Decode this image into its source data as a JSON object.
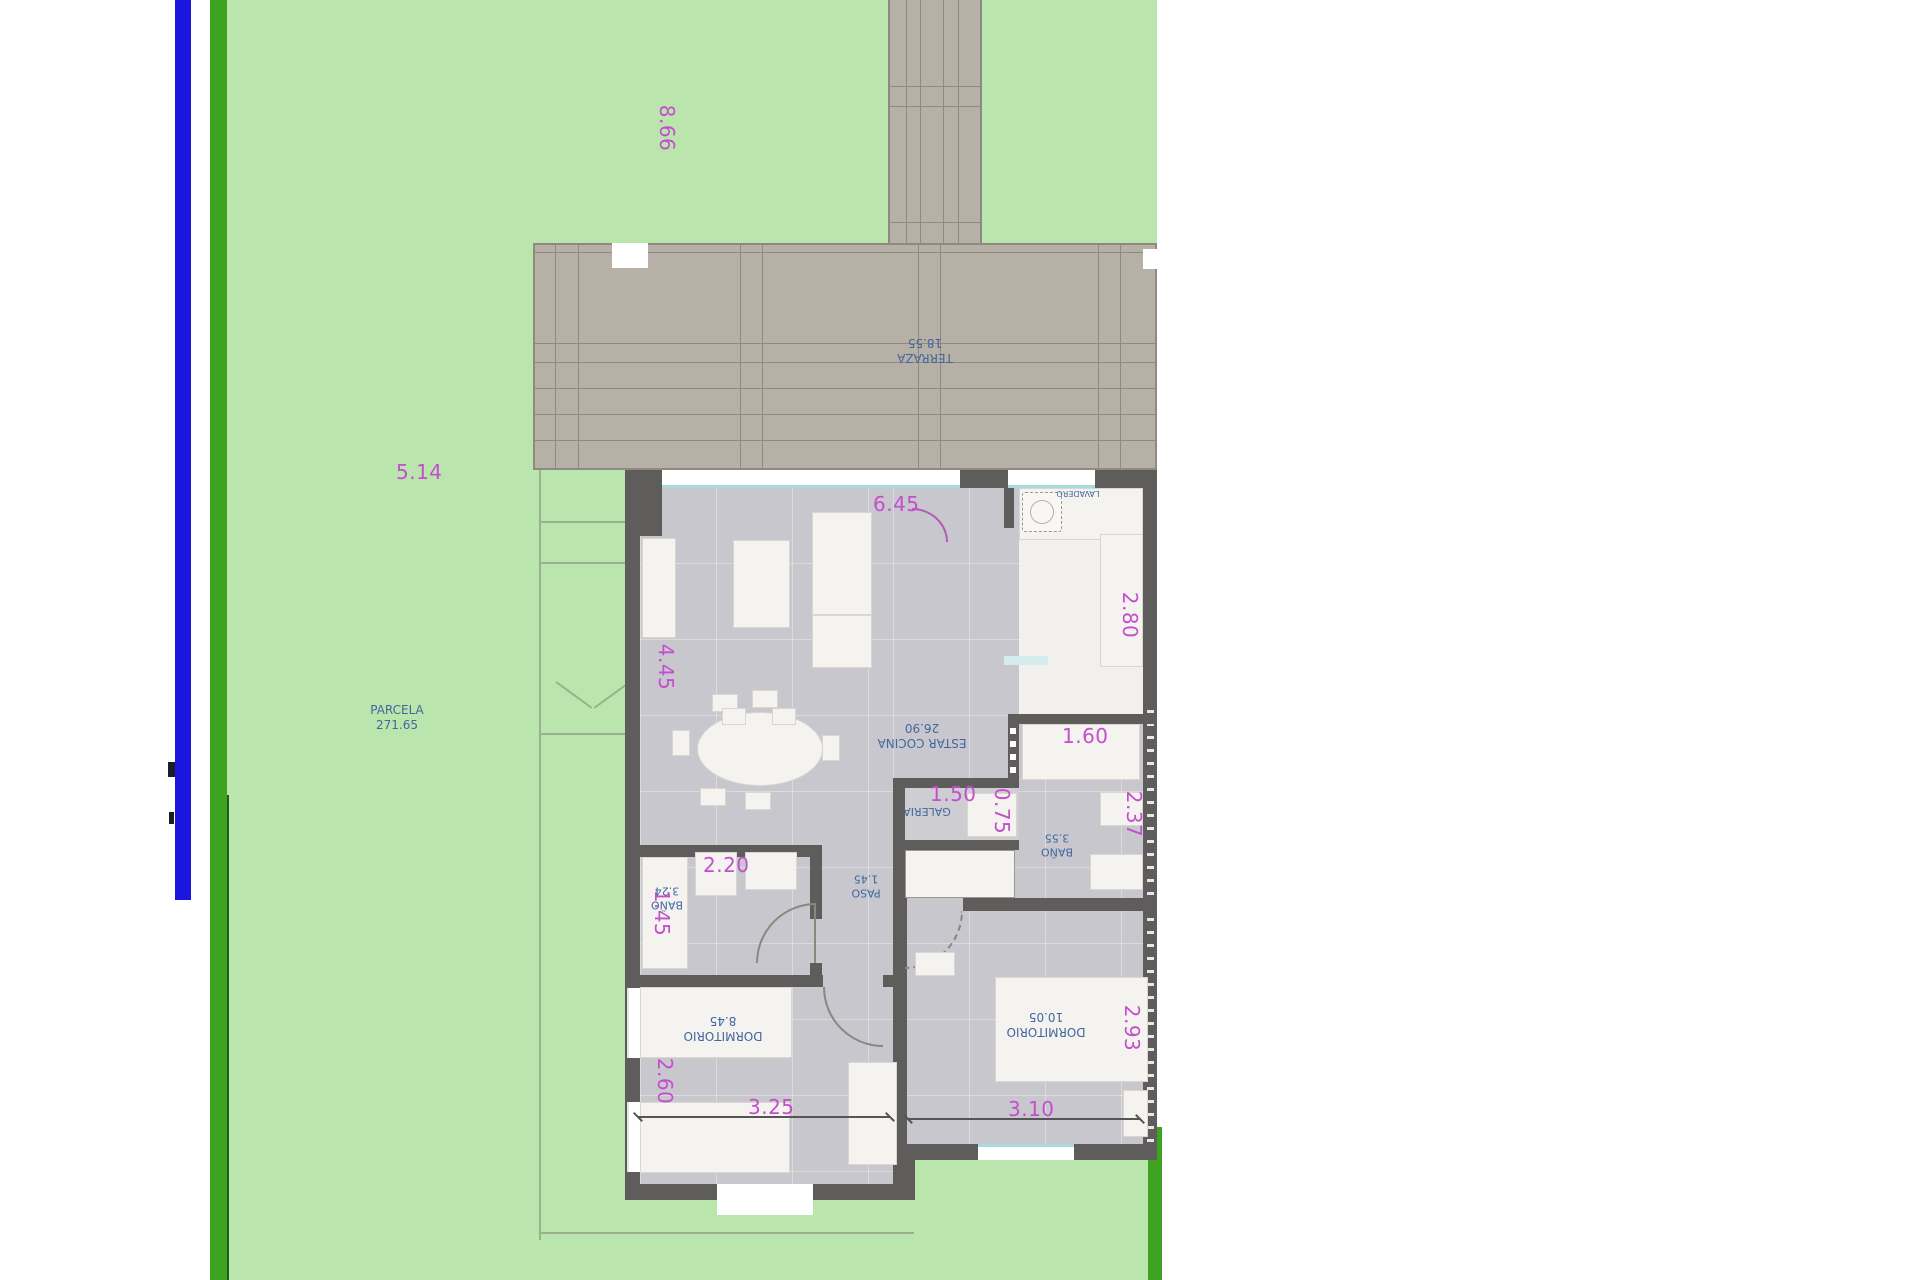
{
  "title": "Floor plan with parcel",
  "colors": {
    "lawn_green": "#bae6ae",
    "boundary_green": "#3fa322",
    "boundary_blue": "#1a16dd",
    "terrace_gray": "#b6b0a7",
    "wall_gray": "#5e5d5b",
    "floor_gray": "#c7c7cd",
    "dimension_magenta": "#c44ecd",
    "label_blue": "#41679e"
  },
  "site": {
    "parcel": {
      "name": "PARCELA",
      "area": "271.65"
    },
    "dim_depth": "8.66",
    "dim_front": "5.14"
  },
  "terraza": {
    "name": "TERRAZA",
    "area": "18.55"
  },
  "rooms": {
    "estar": {
      "name": "ESTAR COCINA",
      "area": "26.90",
      "dim_width": "6.45",
      "dim_height": "4.45",
      "dim_counter": "2.80"
    },
    "lavadero": {
      "name": "LAVADERO"
    },
    "galeria": {
      "name": "GALERIA",
      "dim_width": "1.50",
      "dim_depth": "0.75"
    },
    "bano_right": {
      "name": "BAÑO",
      "area": "3.55",
      "dim_width": "1.60",
      "dim_height": "2.37"
    },
    "bano_left": {
      "name": "BAÑO",
      "area": "3.24",
      "dim_width": "2.20",
      "dim_height": "1.45"
    },
    "paso": {
      "name": "PASO",
      "area": "1.45"
    },
    "dorm1": {
      "name": "DORMITORIO",
      "area": "8.45",
      "dim_width": "3.25",
      "dim_height": "2.60"
    },
    "dorm2": {
      "name": "DORMITORIO",
      "area": "10.05",
      "dim_width": "3.10",
      "dim_height": "2.93"
    }
  }
}
